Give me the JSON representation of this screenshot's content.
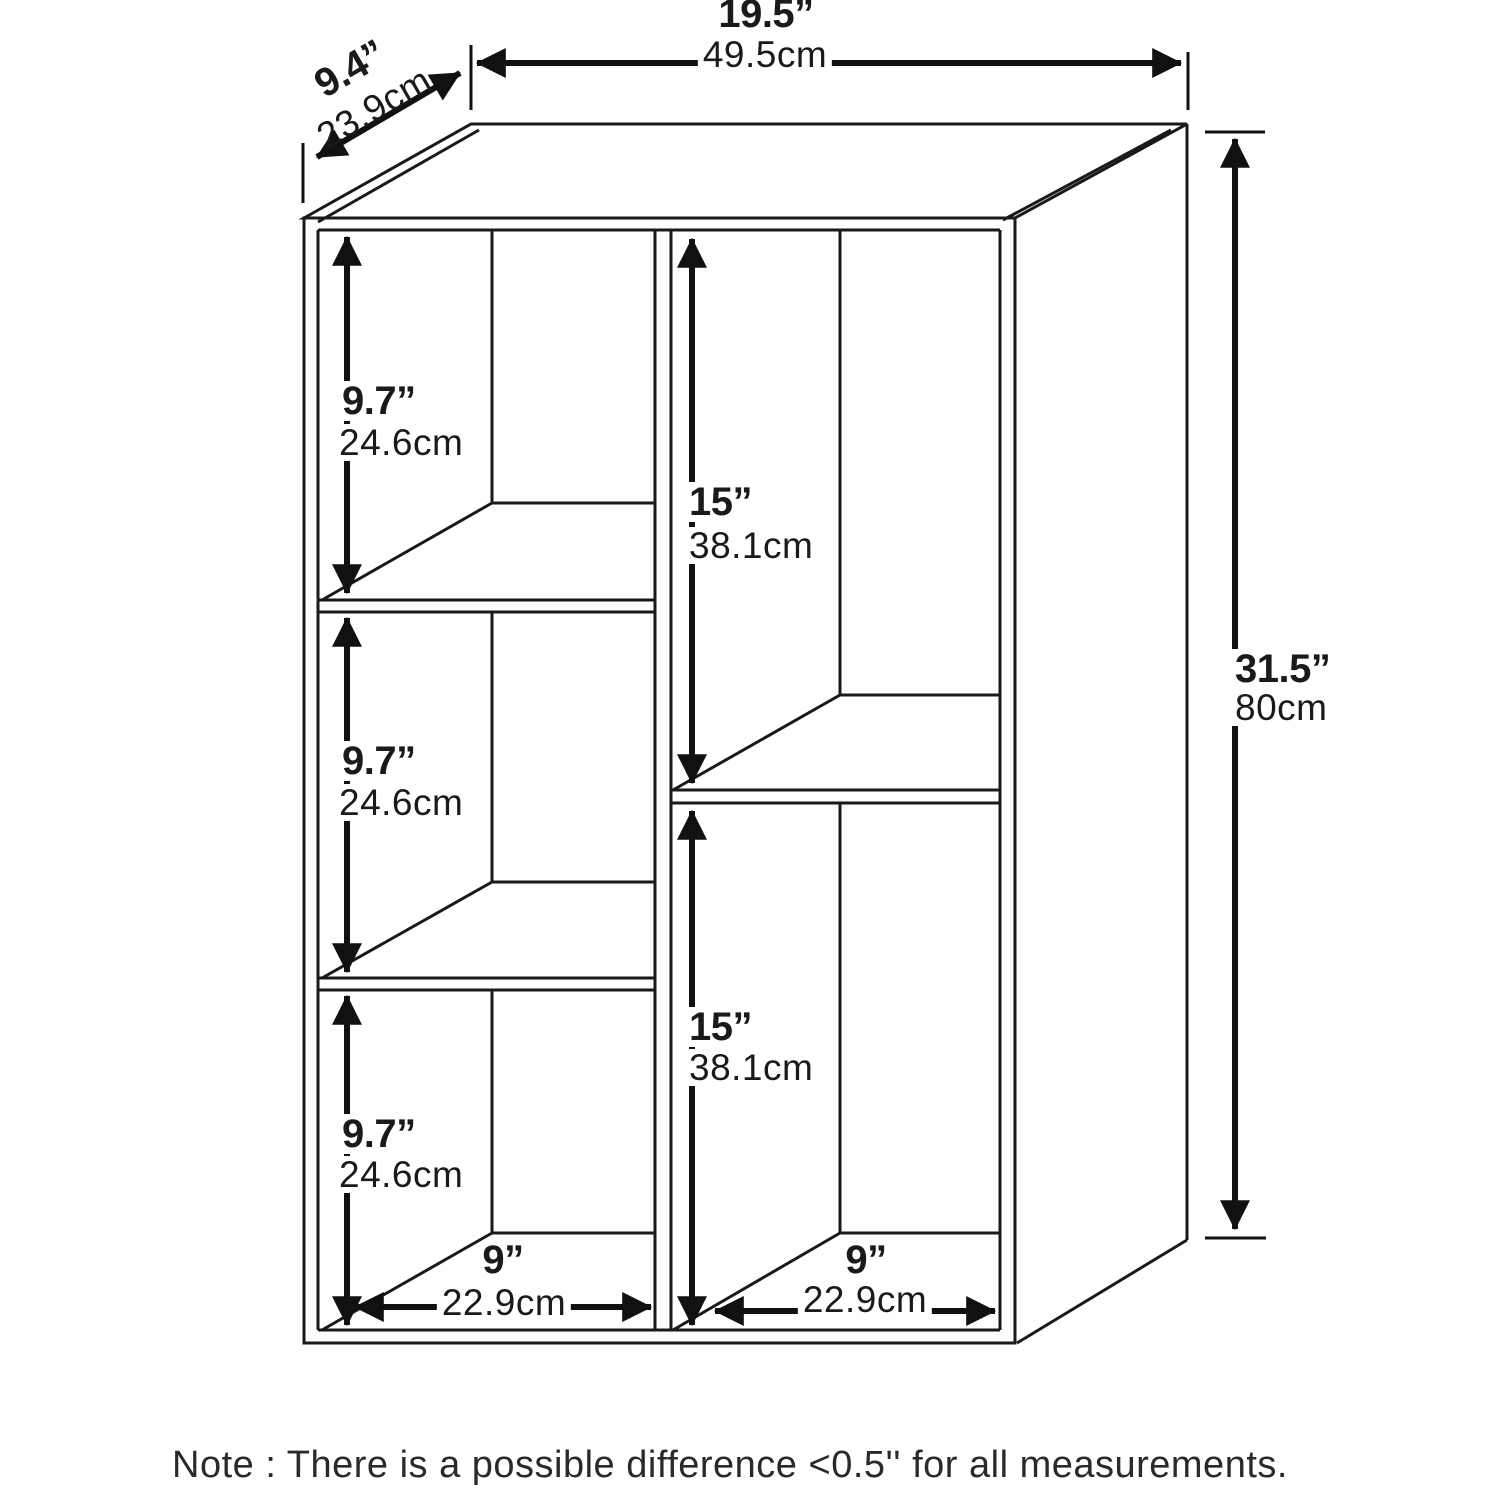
{
  "diagram": {
    "note": "Note : There is a possible difference <0.5'' for all measurements.",
    "dims": {
      "width": {
        "in": "19.5”",
        "cm": "49.5cm"
      },
      "depth": {
        "in": "9.4”",
        "cm": "23.9cm"
      },
      "height": {
        "in": "31.5”",
        "cm": "80cm"
      },
      "left_shelf_1": {
        "in": "9.7”",
        "cm": "24.6cm"
      },
      "left_shelf_2": {
        "in": "9.7”",
        "cm": "24.6cm"
      },
      "left_shelf_3": {
        "in": "9.7”",
        "cm": "24.6cm"
      },
      "right_shelf_1": {
        "in": "15”",
        "cm": "38.1cm"
      },
      "right_shelf_2": {
        "in": "15”",
        "cm": "38.1cm"
      },
      "cubby_width_left": {
        "in": "9”",
        "cm": "22.9cm"
      },
      "cubby_width_right": {
        "in": "9”",
        "cm": "22.9cm"
      }
    },
    "colors": {
      "line": "#1a1a1a",
      "arrow": "#111111",
      "background": "#ffffff"
    }
  }
}
